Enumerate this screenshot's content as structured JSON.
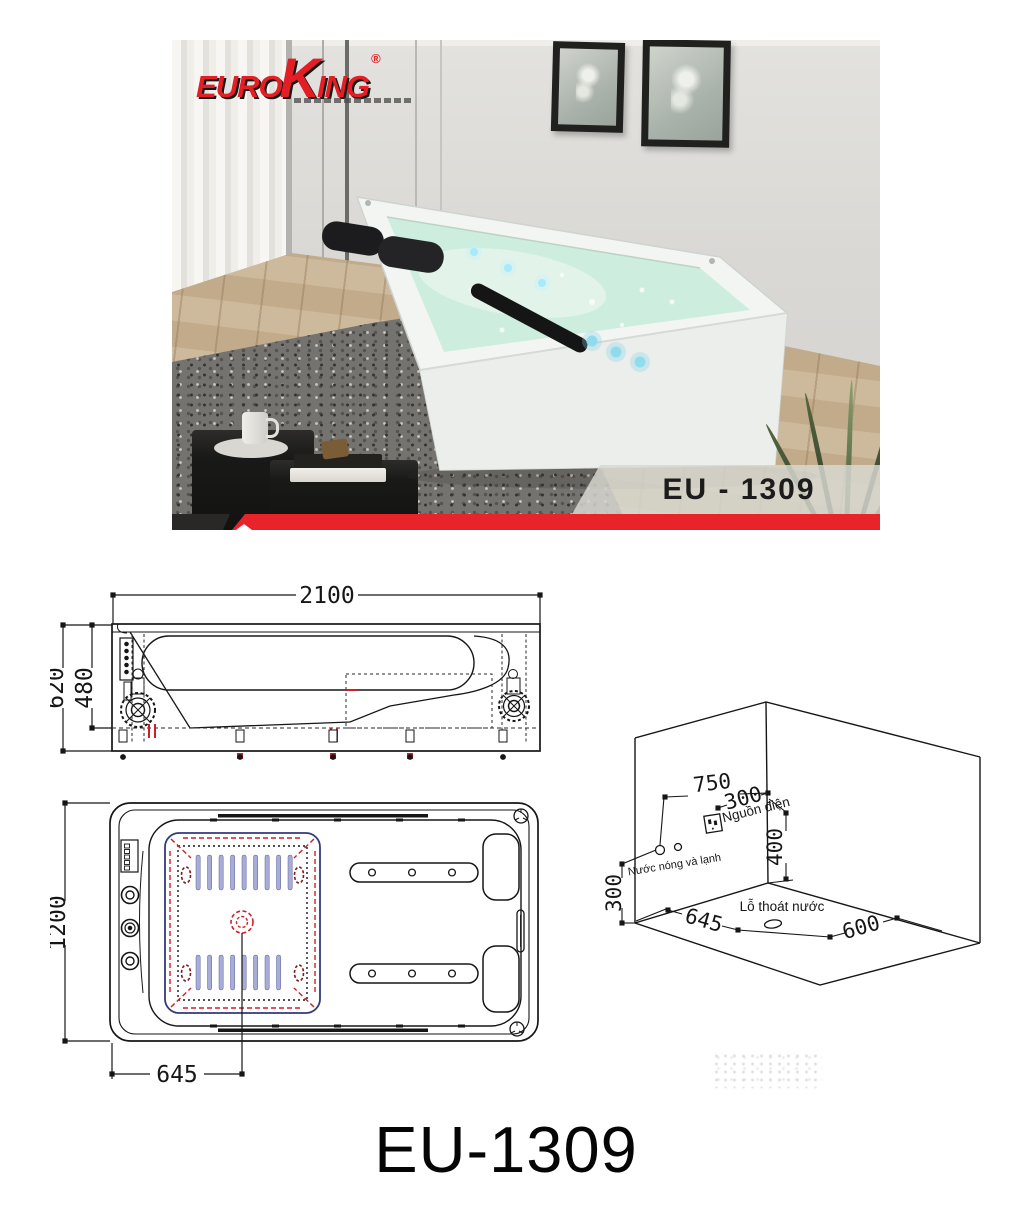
{
  "product": {
    "model_title": "EU-1309",
    "photo_badge": "EU - 1309"
  },
  "brand": {
    "logo_euro": "EURO",
    "logo_k": "K",
    "logo_ing": "ING",
    "registered_mark": "®"
  },
  "side_view": {
    "dim_width": "2100",
    "dim_height_total": "620",
    "dim_height_inner": "480"
  },
  "top_view": {
    "dim_length": "1200",
    "dim_drain_offset": "645"
  },
  "installation": {
    "dim_wall_offset": "750",
    "dim_outlet_offset": "300",
    "dim_outlet_height": "400",
    "dim_water_height": "300",
    "dim_floor_left": "645",
    "dim_floor_right": "600",
    "label_power": "Nguồn điện",
    "label_water": "Nước nóng và lạnh",
    "label_drain": "Lỗ thoát nước"
  },
  "colors": {
    "accent_red": "#e8232a",
    "drawing_red": "#cc2027",
    "jet_dark_red": "#7d171a",
    "slat_blue": "#a7add6",
    "navy": "#333a78",
    "water_mint": "#bfe9d6"
  }
}
